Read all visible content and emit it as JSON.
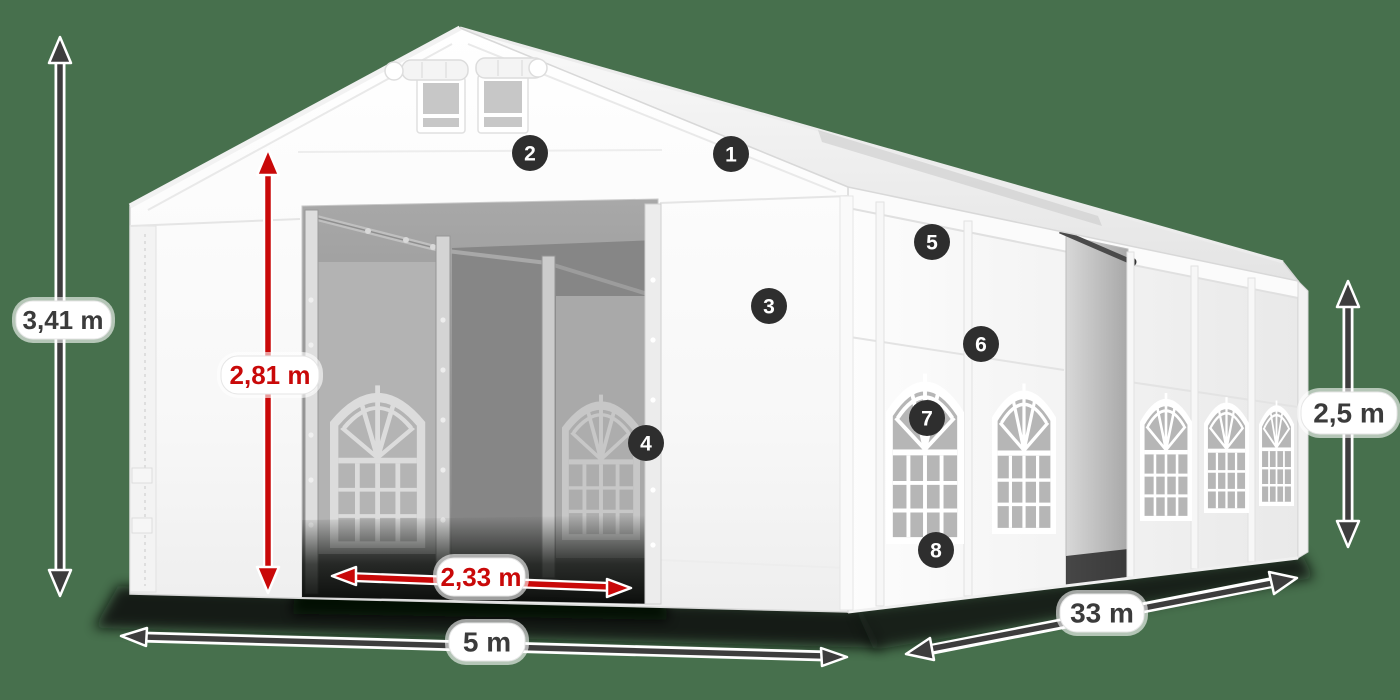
{
  "diagram": {
    "subject": "party-tent-dimension-diagram",
    "colors": {
      "background": "#47704D",
      "dimension_dark": "#3d3d3d",
      "dimension_red": "#c90909",
      "badge_background": "#2e2e2e",
      "badge_text": "#ffffff",
      "tent_white": "#ffffff"
    },
    "dimensions": {
      "total_height": "3,41 m",
      "entrance_height": "2,81 m",
      "entrance_width": "2,33 m",
      "tent_width": "5 m",
      "tent_length": "33 m",
      "side_height": "2,5 m"
    },
    "badges": [
      {
        "number": "1"
      },
      {
        "number": "2"
      },
      {
        "number": "3"
      },
      {
        "number": "4"
      },
      {
        "number": "5"
      },
      {
        "number": "6"
      },
      {
        "number": "7"
      },
      {
        "number": "8"
      }
    ]
  }
}
